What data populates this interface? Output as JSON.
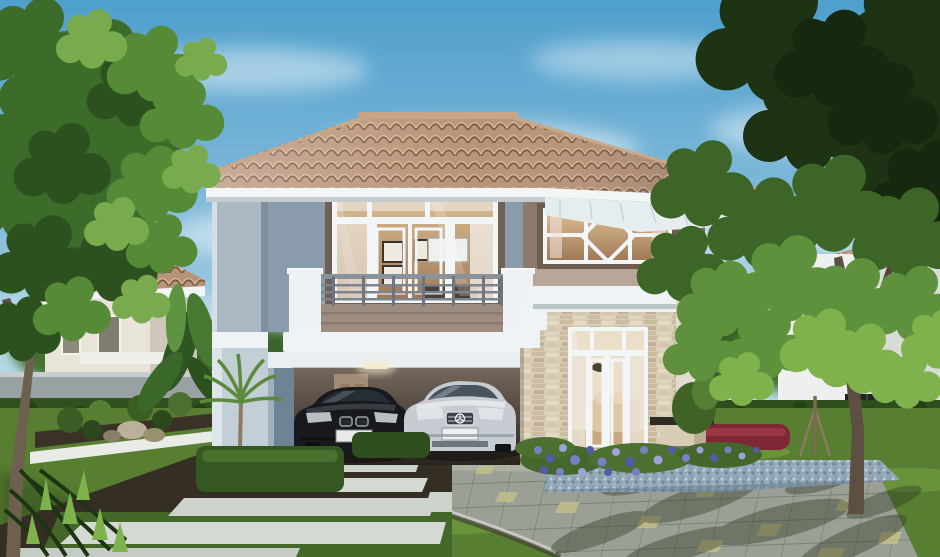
{
  "meta": {
    "title": "Photorealistic 3D architectural rendering of a modern two-storey suburban house",
    "type": "architectural-rendering",
    "time_of_day": "daytime, clear sky"
  },
  "palette": {
    "sky_top": "#4f9fcc",
    "sky_mid": "#8cc0dd",
    "sky_horizon": "#e8f3f7",
    "cloud": "#ffffff",
    "roof_tile": "#b7937a",
    "roof_tile_shadow": "#7a5a43",
    "roof_ridge": "#c9a585",
    "fascia": "#f3f6f7",
    "soffit": "#e6edef",
    "wall_blue_light": "#c3cfd6",
    "wall_blue": "#9dafbc",
    "wall_blue_shadow": "#7f93a2",
    "wall_taupe": "#8d7a6c",
    "wall_taupe_dark": "#6e5c4e",
    "wall_beige": "#b8a798",
    "white_trim": "#eff3f5",
    "glass_warm": "#c29d79",
    "glass_dark": "#8a6f58",
    "curtain": "#ece3d8",
    "railing": "#7c858d",
    "balcony_taupe": "#9d8c80",
    "carport_back": "#5d5148",
    "carport_dark": "#2c2620",
    "carport_door": "#a28b77",
    "stone_light": "#e3d7c3",
    "stone_mid": "#cdbda4",
    "car_black": "#17191d",
    "car_black_highlight": "#4e575f",
    "car_silver": "#c6ccd2",
    "car_silver_shadow": "#8d969e",
    "lawn": "#587f31",
    "lawn_light": "#7fae4a",
    "lawn_shadow": "#2e4a1c",
    "hedge": "#355722",
    "hedge_dark": "#2a451a",
    "tree_green": "#578a39",
    "tree_light": "#8cc05e",
    "tree_dark": "#2f5322",
    "tree_darkest": "#1d3314",
    "trunk": "#6b5a48",
    "path_slab": "#ccd3cc",
    "path_gap": "#352e24",
    "driveway": "#9aa096",
    "driveway_accent": "#c3bf8a",
    "gravel": "#93a7b6",
    "flower_purple": "#7a7ec4",
    "flower_purple_dark": "#575ba6",
    "red_hedge": "#7e2836",
    "concrete_wall": "#99a1a5",
    "license_plate": "#e8eaec"
  },
  "scene": {
    "sky": {
      "label": "clear blue sky with wispy white clouds"
    },
    "main_house": {
      "label": "modern two-storey house with grey-blue and taupe walls",
      "floors": 2,
      "features": [
        "terracotta tiled hip roof with white fascia and deep soffit",
        "second-floor balcony with slim metal railing",
        "full-height warm-glazed window wall behind balcony",
        "feature window with diamond motif on right wing",
        "stacked-stone veneer piers and walls",
        "double carport with downlight and rear door",
        "white-framed french doors opening to lit living room"
      ]
    },
    "vehicles": [
      {
        "label": "black sedan parked in carport, facing viewer"
      },
      {
        "label": "silver sedan parked in carport, facing viewer"
      }
    ],
    "neighborhood": {
      "left_house": "cream two-storey house with terracotta roof behind trees",
      "right_house": "white two-storey house with terracotta roof behind trees",
      "boundary": "grey concrete wall, green hedges and dark slatted fence"
    },
    "landscape": {
      "front": "manicured lawn with modern concrete slab pathway over dark gravel",
      "driveway": "grey paver driveway with pale yellow accent tiles and dappled tree shadow",
      "beds": "purple flower bed, blue-grey pebble wedge, clipped red-leaf hedge, box hedges, rocks, small palm and banana plants",
      "furniture": "small timber-and-stone garden bench, young staked tree",
      "trees": "large leafy tree left foreground, large dark-canopied tree upper right"
    }
  }
}
